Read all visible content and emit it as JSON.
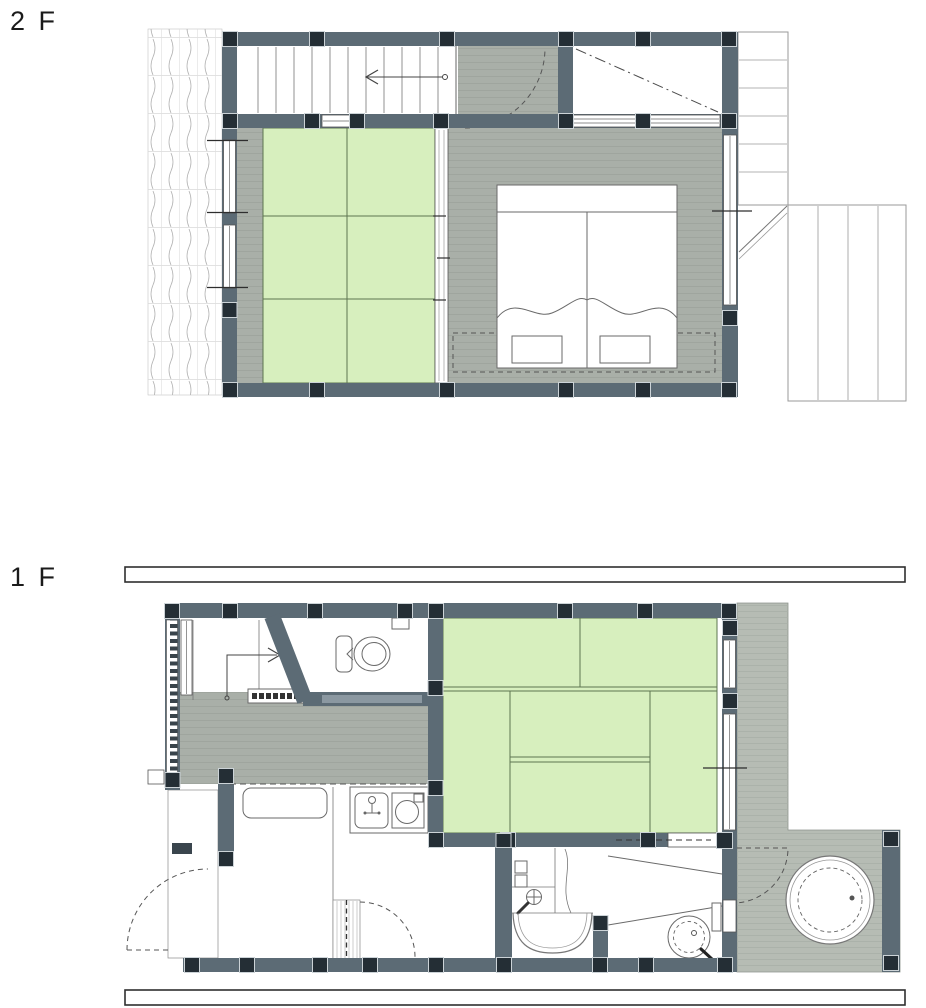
{
  "labels": {
    "floor2": "2 F",
    "floor1": "1 F"
  },
  "colors": {
    "wall": "#5c6b75",
    "post": "#242e35",
    "post_outline": "#ccd3d7",
    "tatami": "#d7efbe",
    "tatami_line": "#5d7450",
    "floor": "#a9afa8",
    "floor_line": "#9ca29b",
    "deck": "#b6bcb4",
    "deck_line": "#a9afa7",
    "fix": "#6a6a6a",
    "dash": "#555555",
    "text": "#1b1b1b",
    "louver": "#39444b",
    "hatch": "#b3b3b3",
    "balc_line": "#9a9a9a",
    "bar_line": "#2f2f2f",
    "bg": "#ffffff"
  }
}
